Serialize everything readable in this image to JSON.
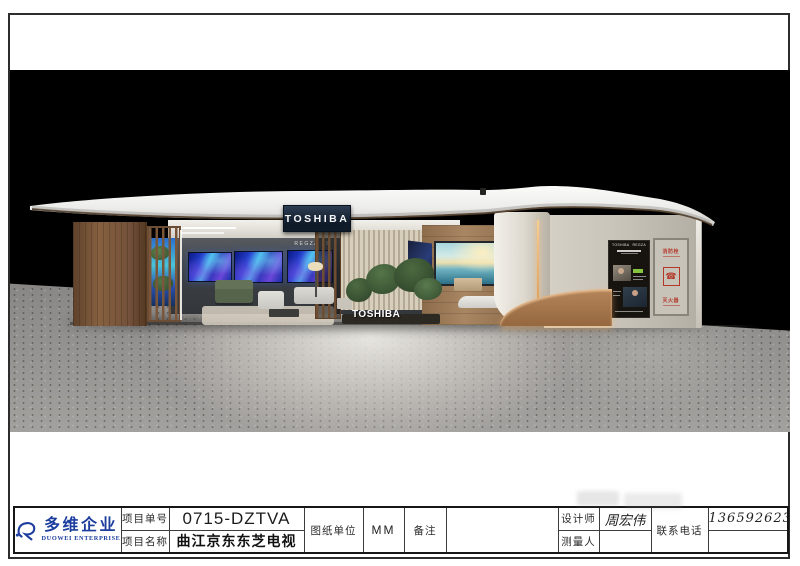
{
  "company": {
    "logo_cn": "多维企业",
    "logo_en": "DUOWEI ENTERPRISE"
  },
  "title_block": {
    "project_no_label": "项目单号",
    "project_no": "0715-DZTVA",
    "project_name_label": "项目名称",
    "project_name": "曲江京东东芝电视",
    "unit_label": "图纸单位",
    "unit": "MM",
    "remark_label": "备注",
    "remark": "",
    "designer_label": "设计师",
    "designer": "周宏伟",
    "surveyor_label": "测量人",
    "surveyor": "",
    "phone_label": "联系电话",
    "phone": "13659262305"
  },
  "rendering": {
    "fascia_sign": "TOSHIBA",
    "display_wall_model": "REGZA Z8",
    "floor_logo": "TOSHIBA",
    "poster_brand_left": "TOSHIBA",
    "poster_brand_right": "REGZA",
    "fire_hydrant_label": "消防栓",
    "fire_extinguisher_label": "灭火器"
  },
  "icons": {
    "fire_phone": "☎"
  },
  "colors": {
    "logo_blue": "#1d3e9e",
    "sign_navy": "#101b29",
    "screen_blue": "#2440d0",
    "fire_red": "#b3382a",
    "wood_brown": "#86603f",
    "wall_greige": "#c9c4ba",
    "scene_background": "#000000"
  }
}
